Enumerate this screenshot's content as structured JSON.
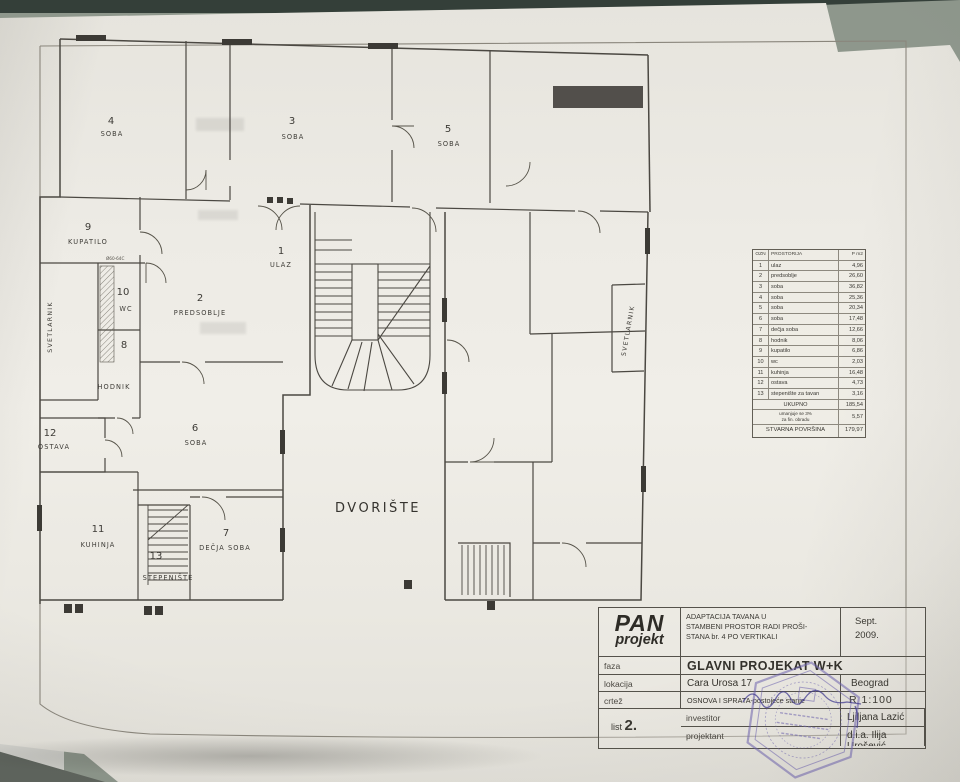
{
  "plan": {
    "rooms": [
      {
        "n": "4",
        "label": "SOBA"
      },
      {
        "n": "3",
        "label": "SOBA"
      },
      {
        "n": "5",
        "label": "SOBA"
      },
      {
        "n": "9",
        "label": "KUPATILO"
      },
      {
        "n": "1",
        "label": "ULAZ"
      },
      {
        "n": "2",
        "label": "PREDSOBLJE"
      },
      {
        "n": "10",
        "label": "WC"
      },
      {
        "n": "8",
        "label": "HODNIK"
      },
      {
        "n": "12",
        "label": "OSTAVA"
      },
      {
        "n": "6",
        "label": "SOBA"
      },
      {
        "n": "11",
        "label": "KUHINJA"
      },
      {
        "n": "13",
        "label": "STEPENIŠTE"
      },
      {
        "n": "7",
        "label": "DEČJA SOBA"
      }
    ],
    "courtyard": "DVORIŠTE",
    "lightwell": "SVETLARNIK",
    "duct_note": "Ø60-64C"
  },
  "table": {
    "headers": [
      "OZN",
      "PROSTORIJA",
      "P m2"
    ],
    "rows": [
      [
        "1",
        "ulaz",
        "4,96"
      ],
      [
        "2",
        "predsoblje",
        "26,60"
      ],
      [
        "3",
        "soba",
        "36,82"
      ],
      [
        "4",
        "soba",
        "25,36"
      ],
      [
        "5",
        "soba",
        "20,34"
      ],
      [
        "6",
        "soba",
        "17,48"
      ],
      [
        "7",
        "dečja soba",
        "12,66"
      ],
      [
        "8",
        "hodnik",
        "8,06"
      ],
      [
        "9",
        "kupatilo",
        "6,86"
      ],
      [
        "10",
        "wc",
        "2,03"
      ],
      [
        "11",
        "kuhinja",
        "16,48"
      ],
      [
        "12",
        "ostava",
        "4,73"
      ],
      [
        "13",
        "stepenište za tavan",
        "3,16"
      ]
    ],
    "total_label": "UKUPNO",
    "total_value": "185,54",
    "deduct_line1": "umanjuje se 3%",
    "deduct_line2": "za fin. obradu",
    "deduct_value": "5,57",
    "net_label": "STVARNA POVRŠINA",
    "net_value": "179,97"
  },
  "titleblock": {
    "logo1": "PAN",
    "logo2": "projekt",
    "proj1": "ADAPTACIJA TAVANA U",
    "proj2": "STAMBENI PROSTOR RADI PROŠI-",
    "proj3": "STANA br. 4 PO VERTIKALI",
    "date1": "Sept.",
    "date2": "2009.",
    "faza_label": "faza",
    "faza_value": "GLAVNI PROJEKAT W+K",
    "lokacija_label": "lokacija",
    "lokacija_value": "Cara Urosa 17",
    "city": "Beograd",
    "crtez_label": "crtež",
    "crtez_value": "OSNOVA I SPRATA-postojeće stanje",
    "scale": "R 1:100",
    "investitor_label": "investitor",
    "investitor_value": "Ljiljana Lazić",
    "sheet_word": "list",
    "sheet_num": "2.",
    "projektant_label": "projektant",
    "projektant_value": "d.i.a. Ilija Urošević"
  }
}
